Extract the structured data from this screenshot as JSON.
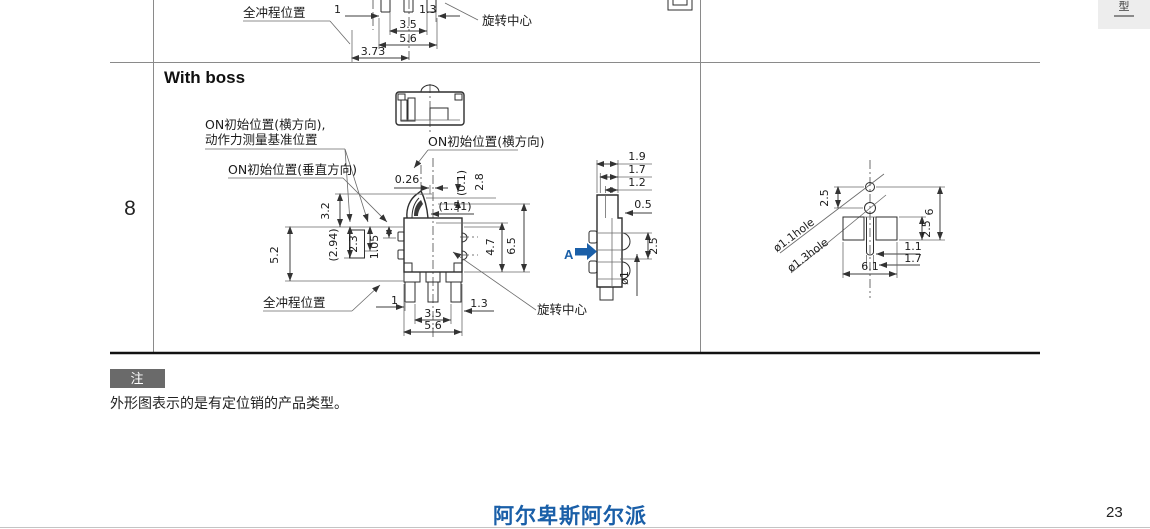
{
  "page": {
    "row_number": "8",
    "page_number": "23",
    "footer_logo": "阿尔卑斯阿尔派",
    "tab_label": "型"
  },
  "colors": {
    "accent_blue": "#1a5fa8",
    "note_badge_bg": "#6a6a6a"
  },
  "note": {
    "badge": "注",
    "text": "外形图表示的是有定位销的产品类型。"
  },
  "section_heading": "With boss",
  "top_row": {
    "full_stroke_label": "全冲程位置",
    "rotation_center_label": "旋转中心",
    "dims": {
      "w1": "1",
      "w13": "1.3",
      "w35": "3.5",
      "w56": "5.6",
      "w373": "3.73"
    }
  },
  "with_boss": {
    "labels": {
      "on_init_h_force_line1": "ON初始位置(横方向),",
      "on_init_h_force_line2": "动作力测量基准位置",
      "on_init_v": "ON初始位置(垂直方向)",
      "on_init_h": "ON初始位置(横方向)",
      "full_stroke": "全冲程位置",
      "rotation_center": "旋转中心",
      "view_letter": "A"
    },
    "front_dims": {
      "d026": "0.26",
      "d01": "(0.1)",
      "d28": "2.8",
      "d151": "(1.51)",
      "d32": "3.2",
      "d294": "(2.94)",
      "d23": "2.3",
      "d105": "1.05",
      "d52": "5.2",
      "d47": "4.7",
      "d65": "6.5",
      "b1": "1",
      "b35": "3.5",
      "b56": "5.6",
      "b13": "1.3"
    },
    "side_dims": {
      "d19": "1.9",
      "d17": "1.7",
      "d12": "1.2",
      "d05": "0.5",
      "d25": "2.5",
      "dia1": "ø1"
    },
    "hole_dims": {
      "c25": "2.5",
      "h6": "6",
      "p25": "2.5",
      "s11": "1.1",
      "s17": "1.7",
      "w61": "6.1",
      "l11": "ø1.1hole",
      "l13": "ø1.3hole"
    }
  }
}
